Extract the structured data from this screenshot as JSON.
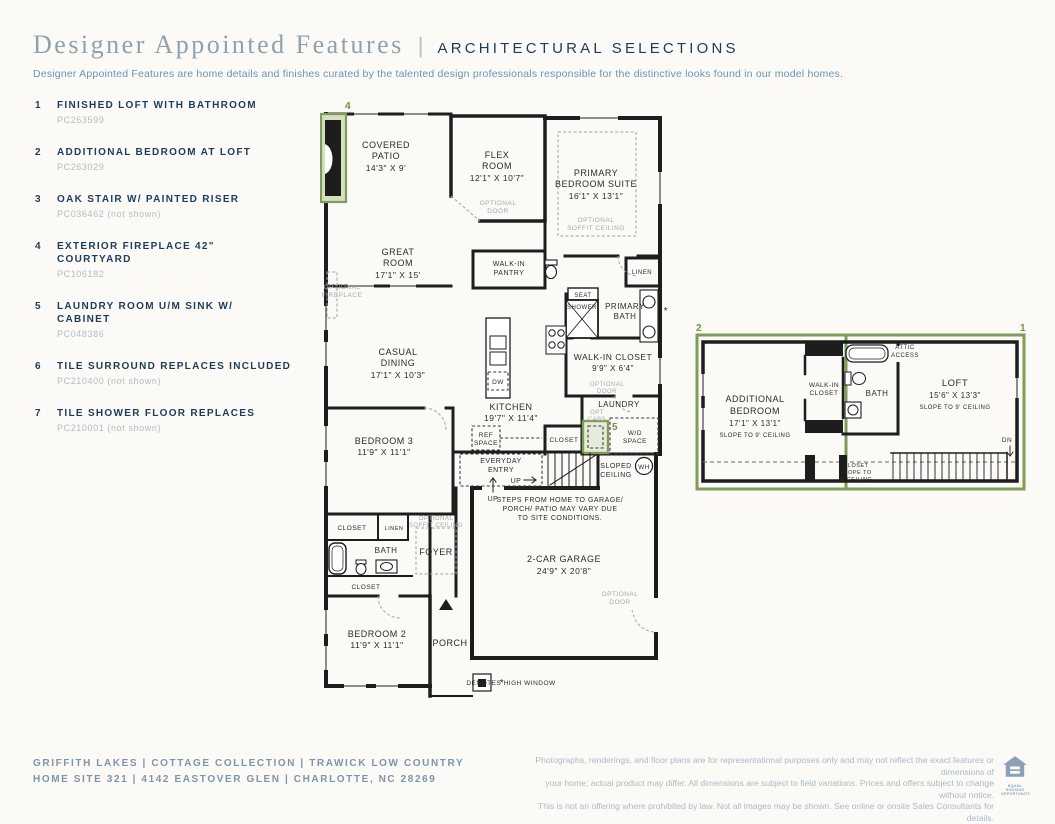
{
  "colors": {
    "navy": "#1d3c5a",
    "slate_title": "#8fa1ac",
    "highlight_green": "#7f9c58",
    "optional_gray": "#a8a8a8"
  },
  "header": {
    "title": "Designer Appointed Features",
    "divider": "|",
    "section": "ARCHITECTURAL SELECTIONS",
    "description": "Designer Appointed Features are home details and finishes curated by the talented design professionals responsible for the distinctive looks found in our model homes."
  },
  "features": [
    {
      "num": "1",
      "title": "FINISHED LOFT WITH BATHROOM",
      "code": "PC263599"
    },
    {
      "num": "2",
      "title": "ADDITIONAL BEDROOM AT LOFT",
      "code": "PC263029"
    },
    {
      "num": "3",
      "title": "OAK STAIR W/ PAINTED RISER",
      "code": "PC036462 (not shown)"
    },
    {
      "num": "4",
      "title": "EXTERIOR FIREPLACE 42\" COURTYARD",
      "code": "PC106182"
    },
    {
      "num": "5",
      "title": "LAUNDRY ROOM U/M SINK W/ CABINET",
      "code": "PC048386"
    },
    {
      "num": "6",
      "title": "TILE SURROUND REPLACES INCLUDED",
      "code": "PC210400 (not shown)"
    },
    {
      "num": "7",
      "title": "TILE SHOWER FLOOR REPLACES",
      "code": "PC210001 (not shown)"
    }
  ],
  "main_plan": {
    "callout_4": "4",
    "callout_5": "5",
    "covered_patio": [
      "COVERED",
      "PATIO",
      "14'3\" X 9'"
    ],
    "flex_room": [
      "FLEX",
      "ROOM",
      "12'1\" X 10'7\""
    ],
    "optional_door": [
      "OPTIONAL",
      "DOOR"
    ],
    "primary_suite": [
      "PRIMARY",
      "BEDROOM SUITE",
      "16'1\" X 13'1\""
    ],
    "optional_soffit": [
      "OPTIONAL",
      "SOFFIT CEILING"
    ],
    "great_room": [
      "GREAT",
      "ROOM",
      "17'1\" X 15'"
    ],
    "optional_fireplace": [
      "OPTIONAL",
      "FIREPLACE"
    ],
    "walk_in_pantry": [
      "WALK-IN",
      "PANTRY"
    ],
    "linen": "LINEN",
    "seat": "SEAT",
    "shower": "SHOWER",
    "primary_bath": [
      "PRIMARY",
      "BATH"
    ],
    "walk_in_closet": [
      "WALK-IN CLOSET",
      "9'9\" X 6'4\""
    ],
    "casual_dining": [
      "CASUAL",
      "DINING",
      "17'1\" X 10'3\""
    ],
    "dw": "DW",
    "kitchen": [
      "KITCHEN",
      "19'7\" X 11'4\""
    ],
    "ref_space": [
      "REF",
      "SPACE"
    ],
    "closet": "CLOSET",
    "laundry": "LAUNDRY",
    "opt_cabs": [
      "OPT",
      "CABS"
    ],
    "wd_space": [
      "W/D",
      "SPACE"
    ],
    "everyday_entry": [
      "EVERYDAY",
      "ENTRY"
    ],
    "up": "UP",
    "sloped_ceiling": [
      "SLOPED",
      "CEILING"
    ],
    "wh": "WH",
    "steps_note": [
      "STEPS FROM HOME TO GARAGE/",
      "PORCH/ PATIO MAY VARY DUE",
      "TO SITE CONDITIONS."
    ],
    "bedroom3": [
      "BEDROOM 3",
      "11'9\" X 11'1\""
    ],
    "bath": "BATH",
    "foyer": "FOYER",
    "bedroom2": [
      "BEDROOM 2",
      "11'9\" X 11'1\""
    ],
    "porch": "PORCH",
    "garage": [
      "2-CAR GARAGE",
      "24'9\" X 20'8\""
    ],
    "asterisk": "*",
    "high_window_note": "DENOTES HIGH WINDOW"
  },
  "loft_plan": {
    "callout_1": "1",
    "callout_2": "2",
    "additional_bedroom": [
      "ADDITIONAL",
      "BEDROOM",
      "17'1\" X 13'1\"",
      "SLOPE TO 9' CEILING"
    ],
    "walk_in_closet": [
      "WALK-IN",
      "CLOSET"
    ],
    "bath": "BATH",
    "attic_access": [
      "ATTIC",
      "ACCESS"
    ],
    "loft": [
      "LOFT",
      "15'6\" X 13'3\"",
      "SLOPE TO 9' CEILING"
    ],
    "closet": [
      "CLOSET",
      "SLOPE TO",
      "9' CEILING"
    ],
    "dn": "DN"
  },
  "footer": {
    "community_line": "GRIFFITH LAKES   |   COTTAGE COLLECTION   |   TRAWICK LOW COUNTRY",
    "address_line": "HOME SITE 321   |   4142 EASTOVER GLEN   |   CHARLOTTE, NC 28269",
    "disclaimer": [
      "Photographs, renderings, and floor plans are for representational purposes only and may not reflect the exact features or dimensions of",
      "your home; actual product may differ. All dimensions are subject to field variations. Prices and offers subject to change without notice.",
      "This is not an offering where prohibited by law. Not all images may be shown. See online or onsite Sales Consultants for details."
    ],
    "equal_housing": [
      "EQUAL HOUSING",
      "OPPORTUNITY"
    ]
  }
}
